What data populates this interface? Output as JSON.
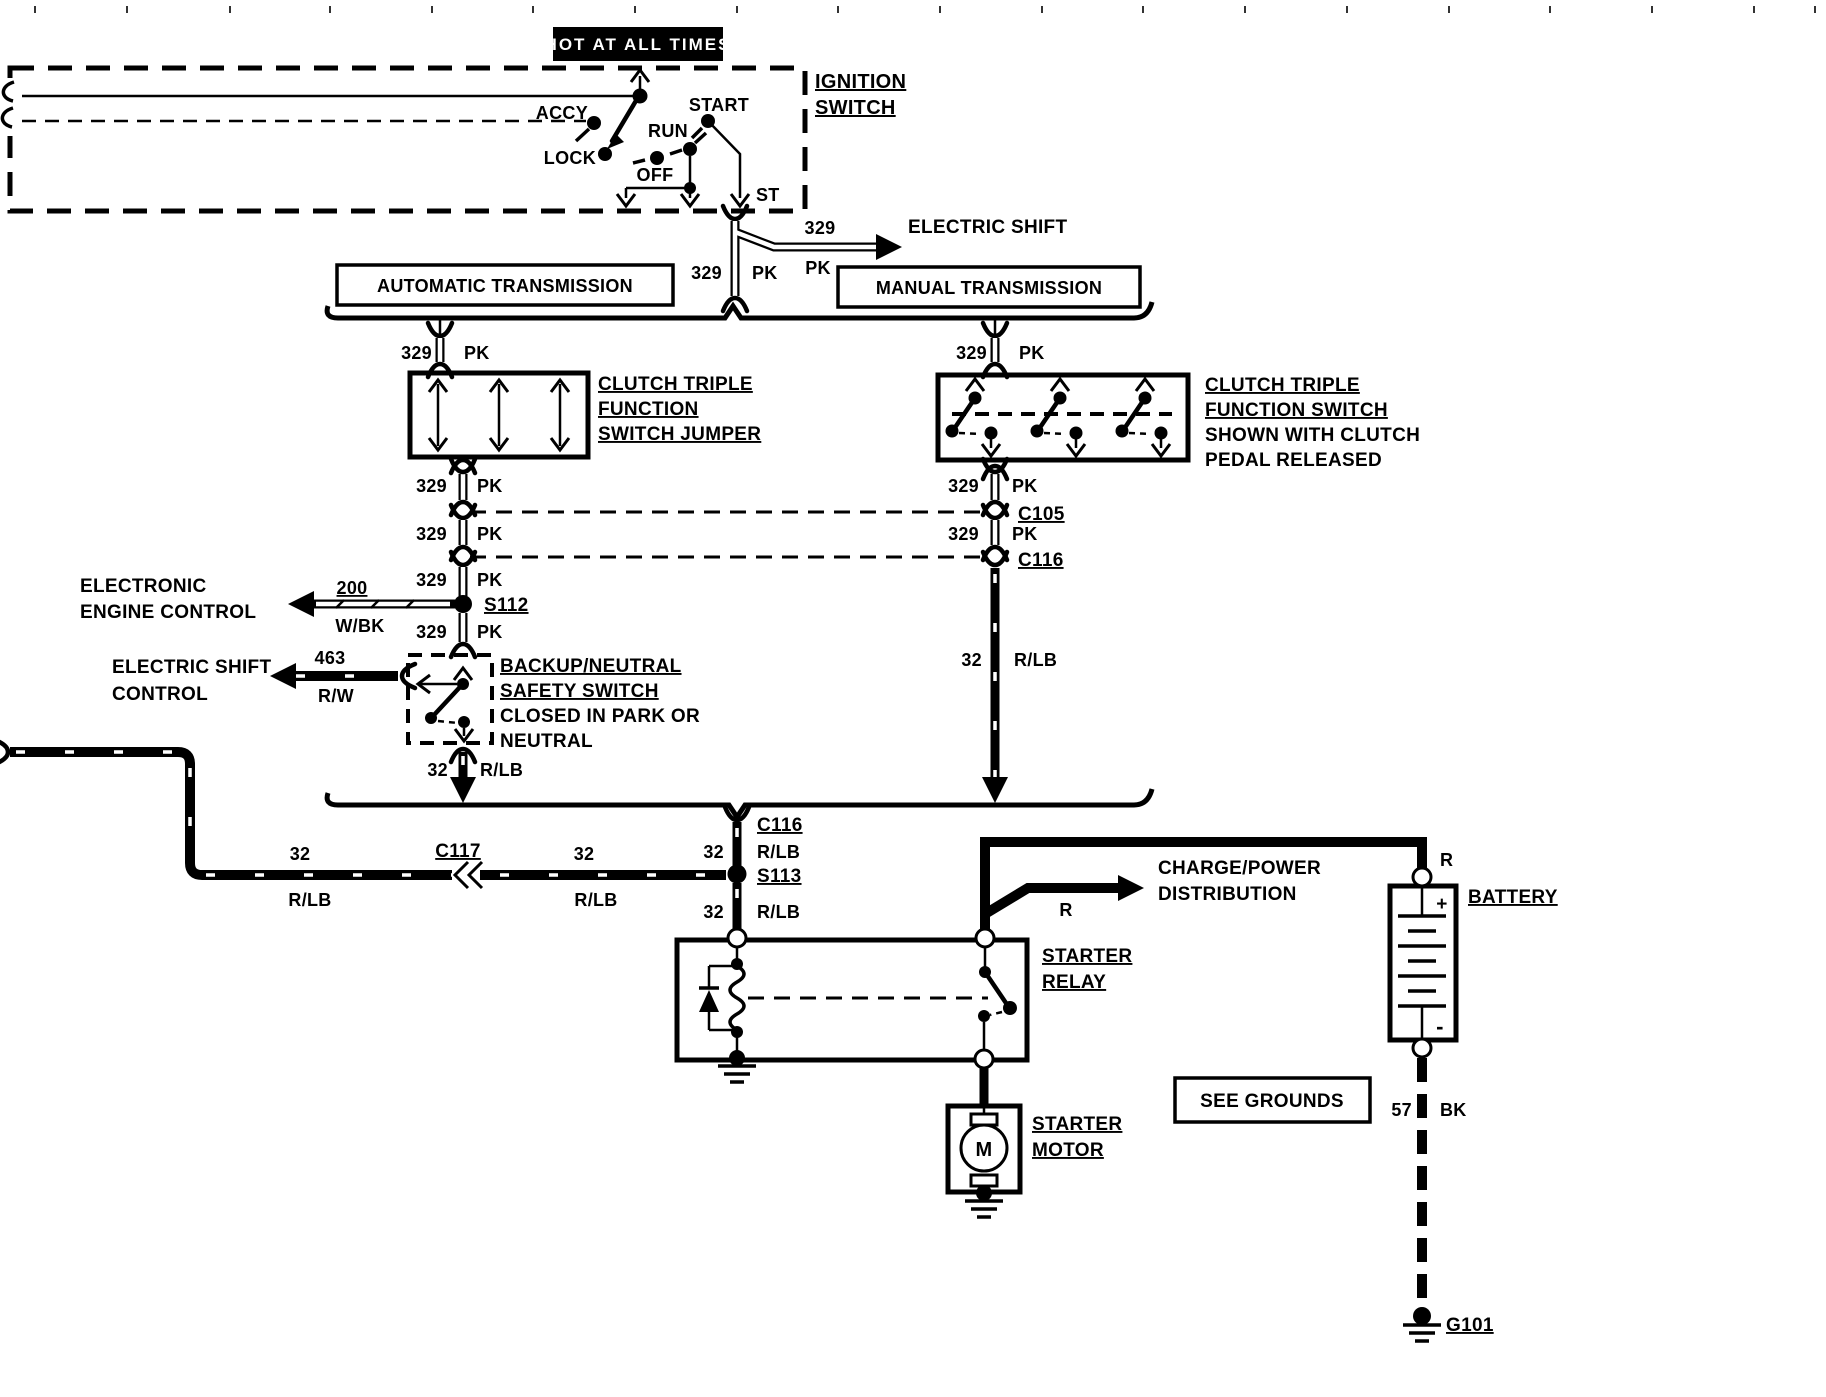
{
  "page": {
    "bg": "#ffffff",
    "ink": "#000000"
  },
  "hot_box": {
    "label": "HOT AT ALL TIMES"
  },
  "ignition_switch": {
    "title1": "IGNITION",
    "title2": "SWITCH",
    "pos_accy": "ACCY",
    "pos_lock": "LOCK",
    "pos_off": "OFF",
    "pos_run": "RUN",
    "pos_start": "START",
    "terminal": "ST"
  },
  "transmissions": {
    "automatic": "AUTOMATIC TRANSMISSION",
    "manual": "MANUAL TRANSMISSION"
  },
  "offpage": {
    "electric_shift": "ELECTRIC SHIFT",
    "eec1": "ELECTRONIC",
    "eec2": "ENGINE CONTROL",
    "esc1": "ELECTRIC SHIFT",
    "esc2": "CONTROL",
    "charge1": "CHARGE/POWER",
    "charge2": "DISTRIBUTION",
    "see_grounds": "SEE GROUNDS"
  },
  "jumper": {
    "l1": "CLUTCH TRIPLE",
    "l2": "FUNCTION",
    "l3": "SWITCH JUMPER"
  },
  "clutch_switch": {
    "l1": "CLUTCH TRIPLE",
    "l2": "FUNCTION SWITCH",
    "n1": "SHOWN WITH CLUTCH",
    "n2": "PEDAL RELEASED"
  },
  "backup_switch": {
    "l1": "BACKUP/NEUTRAL",
    "l2": "SAFETY SWITCH",
    "n1": "CLOSED IN PARK OR",
    "n2": "NEUTRAL"
  },
  "relay": {
    "l1": "STARTER",
    "l2": "RELAY"
  },
  "motor": {
    "l1": "STARTER",
    "l2": "MOTOR",
    "letter": "M"
  },
  "battery": {
    "label": "BATTERY",
    "plus": "+",
    "minus": "-"
  },
  "wires": {
    "w329": {
      "num": "329",
      "color": "PK"
    },
    "w200": {
      "num": "200",
      "color": "W/BK"
    },
    "w463": {
      "num": "463",
      "color": "R/W"
    },
    "w32": {
      "num": "32",
      "color": "R/LB"
    },
    "w57": {
      "num": "57",
      "color": "BK"
    },
    "wR": {
      "color": "R"
    }
  },
  "connectors": {
    "c105": "C105",
    "c116": "C116",
    "c117": "C117"
  },
  "splices": {
    "s112": "S112",
    "s113": "S113"
  },
  "grounds": {
    "g101": "G101"
  }
}
